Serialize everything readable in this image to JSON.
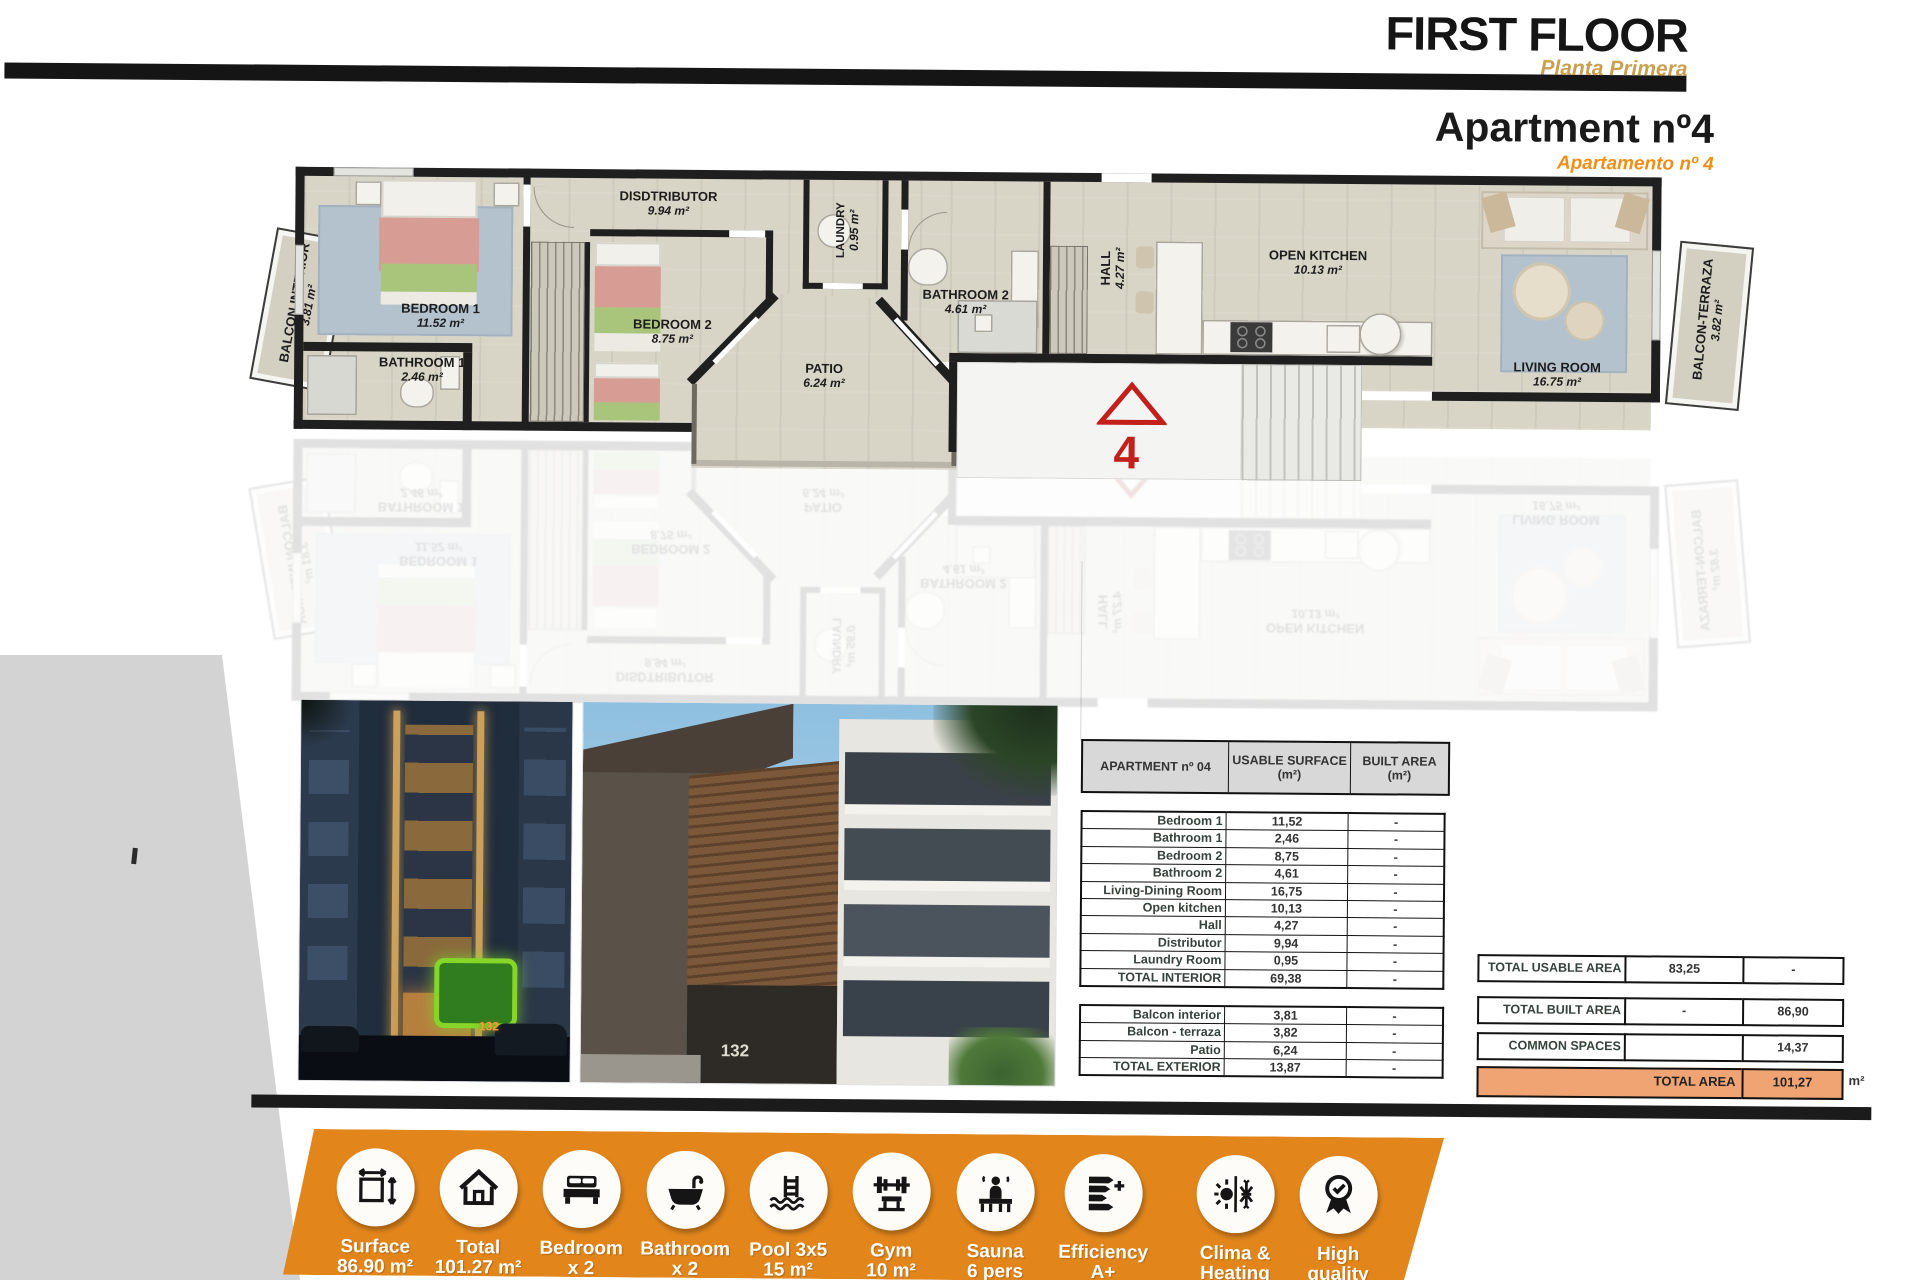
{
  "header": {
    "floor_title": "FIRST FLOOR",
    "floor_subtitle": "Planta Primera",
    "apartment_title": "Apartment nº4",
    "apartment_subtitle": "Apartamento nº 4"
  },
  "floor_plan": {
    "rooms": [
      {
        "name": "BALCON INTERIOR",
        "area": "3.81 m²"
      },
      {
        "name": "BEDROOM 1",
        "area": "11.52 m²"
      },
      {
        "name": "BATHROOM 1",
        "area": "2.46 m²"
      },
      {
        "name": "DISDTRIBUTOR",
        "area": "9.94 m²"
      },
      {
        "name": "BEDROOM 2",
        "area": "8.75 m²"
      },
      {
        "name": "LAUNDRY",
        "area": "0.95 m²"
      },
      {
        "name": "PATIO",
        "area": "6.24 m²"
      },
      {
        "name": "BATHROOM 2",
        "area": "4.61 m²"
      },
      {
        "name": "HALL",
        "area": "4.27 m²"
      },
      {
        "name": "OPEN KITCHEN",
        "area": "10.13 m²"
      },
      {
        "name": "LIVING ROOM",
        "area": "16.75 m²"
      },
      {
        "name": "BALCON-TERRAZA",
        "area": "3.82 m²"
      }
    ],
    "unit_marker": "4"
  },
  "photos": {
    "building_number": "132"
  },
  "area_table": {
    "header": {
      "name": "APARTMENT nº 04",
      "usable_line1": "USABLE SURFACE",
      "usable_line2": "(m²)",
      "built_line1": "BUILT AREA",
      "built_line2": "(m²)"
    },
    "interior_rows": [
      {
        "label": "Bedroom 1",
        "usable": "11,52",
        "built": "-"
      },
      {
        "label": "Bathroom 1",
        "usable": "2,46",
        "built": "-"
      },
      {
        "label": "Bedroom 2",
        "usable": "8,75",
        "built": "-"
      },
      {
        "label": "Bathroom 2",
        "usable": "4,61",
        "built": "-"
      },
      {
        "label": "Living-Dining Room",
        "usable": "16,75",
        "built": "-"
      },
      {
        "label": "Open kitchen",
        "usable": "10,13",
        "built": "-"
      },
      {
        "label": "Hall",
        "usable": "4,27",
        "built": "-"
      },
      {
        "label": "Distributor",
        "usable": "9,94",
        "built": "-"
      },
      {
        "label": "Laundry Room",
        "usable": "0,95",
        "built": "-"
      },
      {
        "label": "TOTAL INTERIOR",
        "usable": "69,38",
        "built": "-"
      }
    ],
    "exterior_rows": [
      {
        "label": "Balcon interior",
        "usable": "3,81",
        "built": "-"
      },
      {
        "label": "Balcon - terraza",
        "usable": "3,82",
        "built": "-"
      },
      {
        "label": "Patio",
        "usable": "6,24",
        "built": "-"
      },
      {
        "label": "TOTAL EXTERIOR",
        "usable": "13,87",
        "built": "-"
      }
    ]
  },
  "summary_table": {
    "rows": [
      {
        "label": "TOTAL USABLE AREA",
        "usable": "83,25",
        "built": "-"
      },
      {
        "label": "TOTAL BUILT AREA",
        "usable": "-",
        "built": "86,90"
      },
      {
        "label": "COMMON SPACES",
        "usable": "",
        "built": "14,37"
      }
    ],
    "total": {
      "label": "TOTAL AREA",
      "value": "101,27",
      "unit": "m²"
    }
  },
  "amenities": [
    {
      "icon": "surface-icon",
      "label": "Surface",
      "value": "86.90 m²"
    },
    {
      "icon": "house-icon",
      "label": "Total",
      "value": "101.27 m²"
    },
    {
      "icon": "bed-icon",
      "label": "Bedroom",
      "value": "x 2"
    },
    {
      "icon": "bathtub-icon",
      "label": "Bathroom",
      "value": "x 2"
    },
    {
      "icon": "pool-icon",
      "label": "Pool 3x5",
      "value": "15 m²"
    },
    {
      "icon": "gym-icon",
      "label": "Gym",
      "value": "10 m²"
    },
    {
      "icon": "sauna-icon",
      "label": "Sauna",
      "value": "6 pers"
    },
    {
      "icon": "efficiency-icon",
      "label": "Efficiency",
      "value": "A+"
    },
    {
      "icon": "climate-icon",
      "label": "Clima &",
      "value": "Heating"
    },
    {
      "icon": "award-icon",
      "label": "High",
      "value": "quality"
    }
  ],
  "colors": {
    "banner_orange": "#e2861c",
    "planta_gold": "#c9a050",
    "apartment_orange": "#ef8f1a",
    "total_area_fill": "#f1a473",
    "marker_red": "#c2201a",
    "plan_floor": "#d8d4c6",
    "wall_black": "#1f1f1f"
  }
}
